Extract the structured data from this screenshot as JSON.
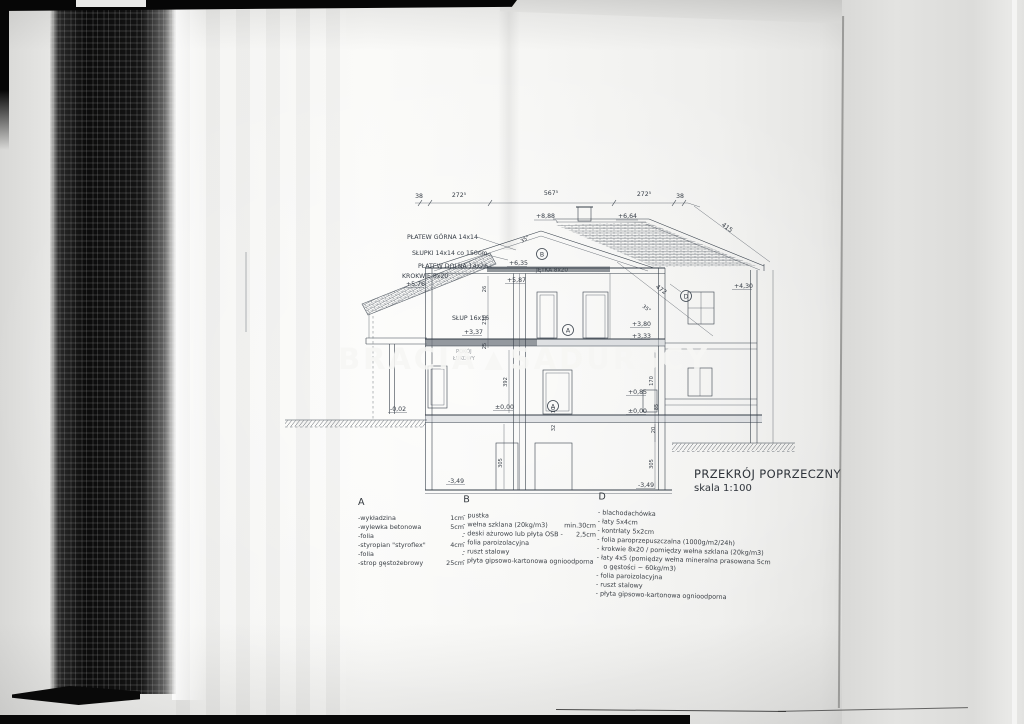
{
  "watermark": {
    "left": "BRACIA",
    "triangle": "▲",
    "right": "SADURSCY"
  },
  "title_block": {
    "title": "PRZEKRÓJ POPRZECZNY",
    "scale": "skala 1:100"
  },
  "drawing": {
    "top_dims": {
      "d1": "38",
      "d2": "272⁵",
      "d3": "567⁵",
      "d4": "272⁵",
      "d5": "38",
      "slope_right": "415",
      "slope_inner": "472"
    },
    "angles": {
      "left": "35°",
      "right": "35°"
    },
    "levels": {
      "ridge": "+8,88",
      "eaves_right": "+6,64",
      "collar_top": "+6,35",
      "collar_bottom": "+5,87",
      "left_eaves": "+5,76",
      "wing_plate": "+4,30",
      "upper_right_a": "+3,80",
      "upper_right_b": "+3,33",
      "upper_left": "+3,37",
      "wing_floor": "+0,85",
      "ground_a": "±0,00",
      "ground_b": "±0,00",
      "garage_floor": "-0,02",
      "basement_a": "-3,49",
      "basement_b": "-3,49"
    },
    "structure": {
      "platew_gorna": "PŁATEW GÓRNA 14x14",
      "slupki": "SŁUPKI 14x14 co 150cm",
      "platew_dolna": "PŁATEW DOLNA 14x26",
      "krokwie": "KROKWIE 8x20",
      "slup": "SŁUP 16x16",
      "jetka": "JĘTKA 8x20"
    },
    "markers": {
      "a": "A",
      "a2": "A",
      "b": "B",
      "d": "D"
    },
    "room": {
      "line1": "POKÓJ",
      "line2": "ŁUKOWY"
    },
    "vdims": {
      "v26": "26",
      "v230": "230",
      "v25": "25",
      "v392": "392",
      "v305a": "305",
      "v305b": "305",
      "v170": "170",
      "v85": "85",
      "v20": "20",
      "v10": "10",
      "v32": "32"
    }
  },
  "legend": {
    "a": {
      "header": "A",
      "items": [
        {
          "label": "-wykładzina",
          "value": "1cm"
        },
        {
          "label": "-wylewka betonowa",
          "value": "5cm"
        },
        {
          "label": "-folia",
          "value": "-"
        },
        {
          "label": "-styropian \"styroflex\"",
          "value": "4cm"
        },
        {
          "label": "-folia",
          "value": "-"
        },
        {
          "label": "-strop gęstożebrowy",
          "value": "25cm"
        }
      ]
    },
    "b": {
      "header": "B",
      "items": [
        {
          "label": "- pustka",
          "value": ""
        },
        {
          "label": "- wełna szklana (20kg/m3)",
          "value": "min.30cm"
        },
        {
          "label": "- deski ażurowo lub płyta OSB -",
          "value": "2,5cm"
        },
        {
          "label": "- folia paroizolacyjna",
          "value": ""
        },
        {
          "label": "- ruszt stalowy",
          "value": ""
        },
        {
          "label": "- płyta gipsowo-kartonowa ognioodporna",
          "value": ""
        }
      ]
    },
    "d": {
      "header": "D",
      "items": [
        "- blachodachówka",
        "- łaty 5x4cm",
        "- kontrłaty 5x2cm",
        "- folia paroprzepuszczalna (1000g/m2/24h)",
        "- krokwie 8x20 / pomiędzy wełna szklana (20kg/m3)",
        "- łaty 4x5 (pomiędzy wełna mineralna prasowana 5cm",
        "o gęstości ~ 60kg/m3)",
        "- folia paroizolacyjna",
        "- ruszt stalowy",
        "- płyta gipsowo-kartonowa ognioodporna"
      ]
    }
  }
}
